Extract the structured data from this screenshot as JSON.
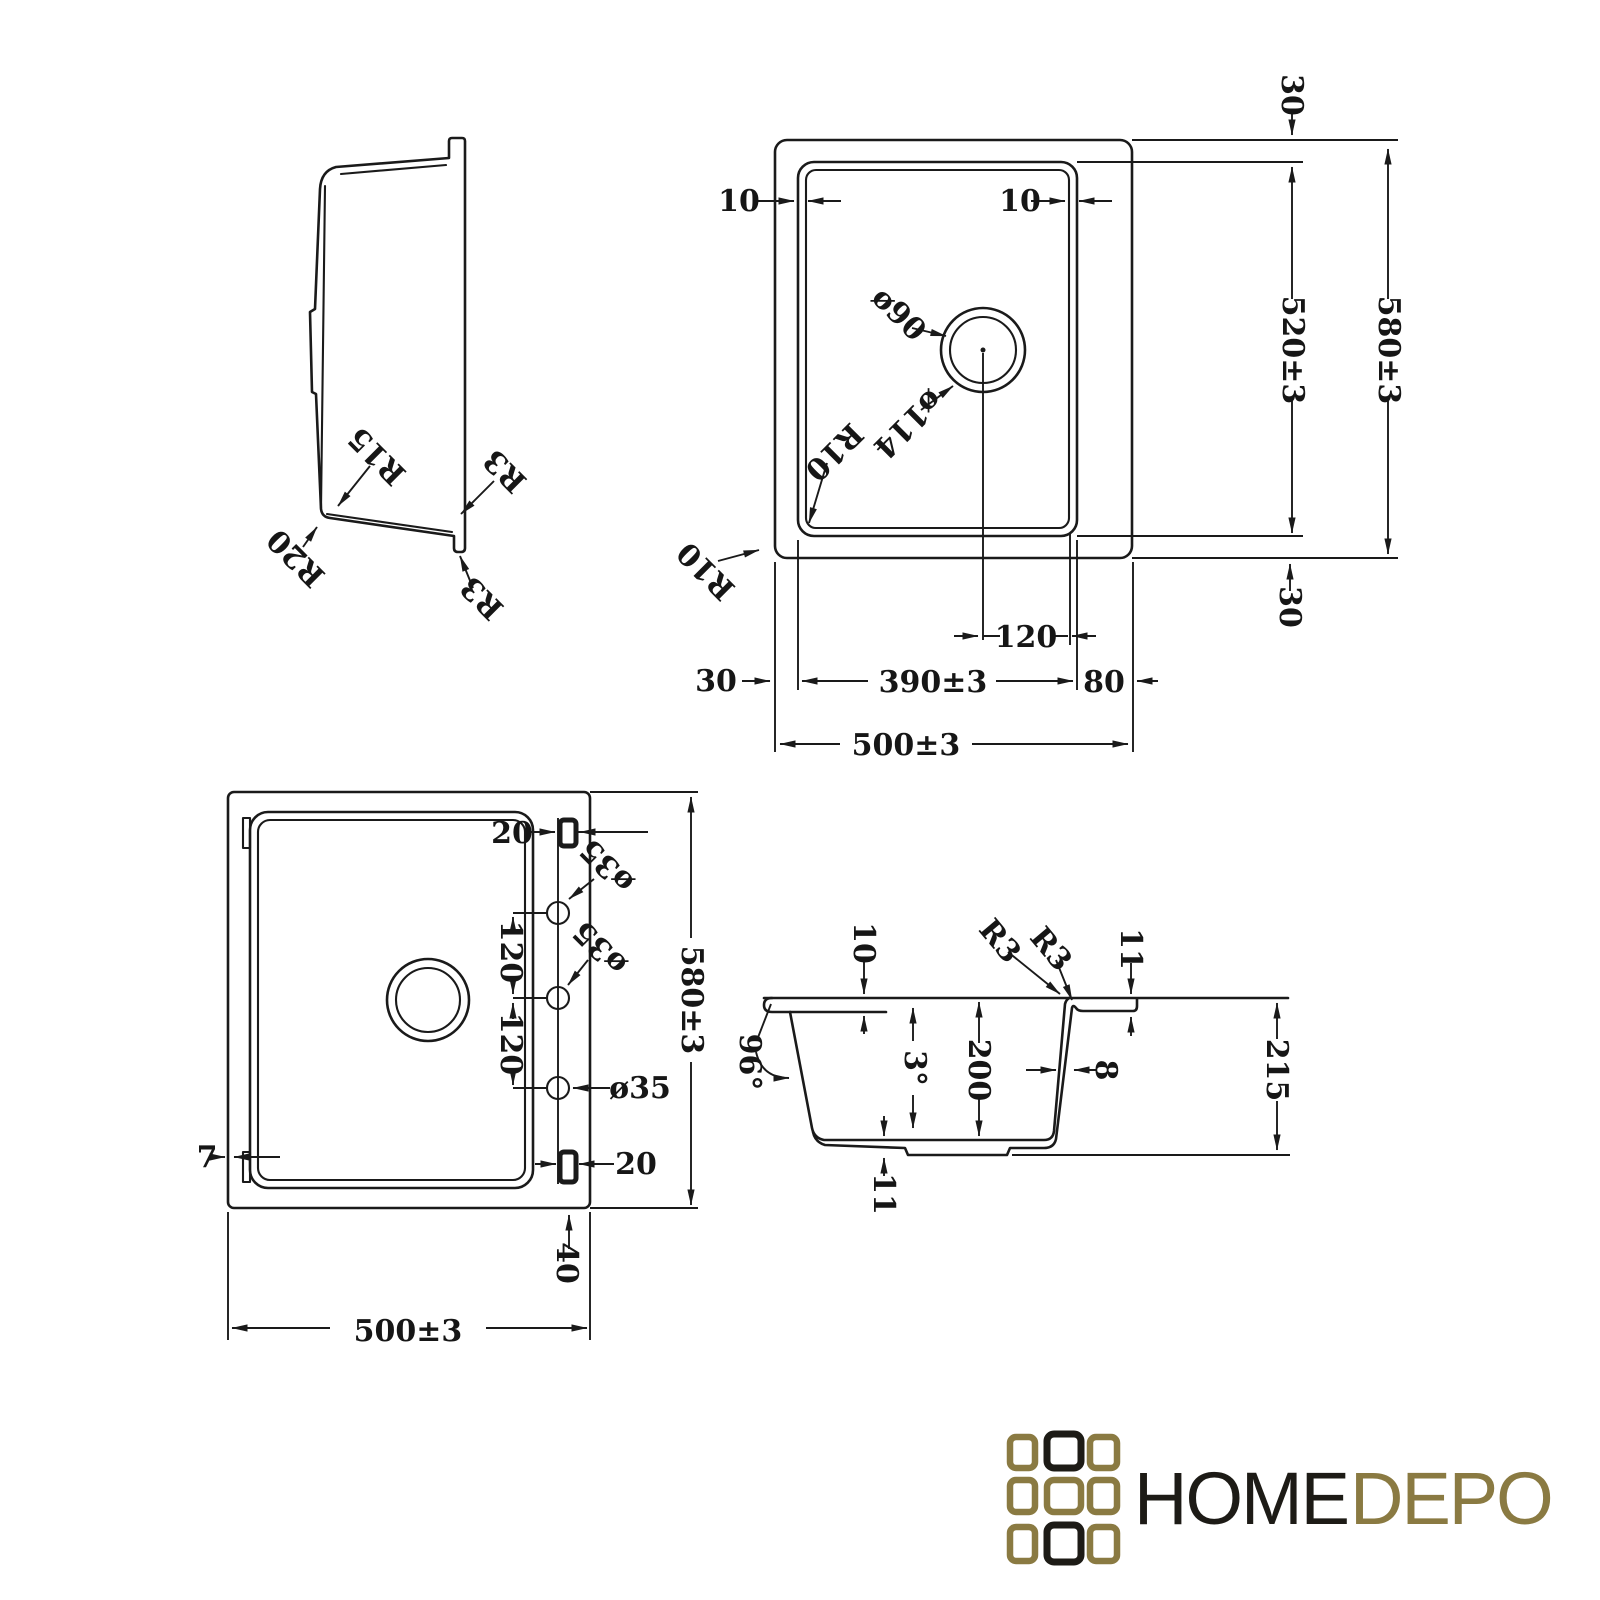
{
  "drawing": {
    "side_profile": {
      "r15": "R15",
      "r20": "R20",
      "r3_top": "R3",
      "r3_bottom": "R3"
    },
    "top_plan": {
      "rim_left": "10",
      "rim_right": "10",
      "drain_hole_dia": "ø90",
      "drain_flange_dia": "ø114",
      "bowl_corner_radius": "R10",
      "outer_corner_radius": "R10",
      "margin_top": "30",
      "bowl_height": "520±3",
      "overall_height": "580±3",
      "margin_bottom": "30",
      "drain_offset": "120",
      "margin_left": "30",
      "bowl_width": "390±3",
      "right_flange_width": "80",
      "overall_width": "500±3"
    },
    "bottom_plan": {
      "slot_top": "20",
      "tap_hole1_dia": "ø35",
      "hole_pitch1": "120",
      "tap_hole2_dia": "ø35",
      "hole_pitch2": "120",
      "tap_hole3_dia": "ø35",
      "lip_width": "7",
      "slot_bottom": "20",
      "bottom_offset": "40",
      "overall_width": "500±3",
      "overall_height": "580±3"
    },
    "section": {
      "rim_step": "10",
      "r3_inner": "R3",
      "r3_outer": "R3",
      "ledge_step": "11",
      "corner_angle": "96°",
      "wall_angle": "3°",
      "bowl_depth": "200",
      "wall_thickness": "8",
      "overall_height": "215",
      "bottom_thickness": "11"
    }
  },
  "logo": {
    "word_primary": "HOME",
    "word_secondary": "DEPO"
  },
  "colors": {
    "line": "#1a1a1a",
    "logo_gold": "#8a7a42",
    "logo_black": "#1d1b16",
    "background": "#ffffff"
  }
}
